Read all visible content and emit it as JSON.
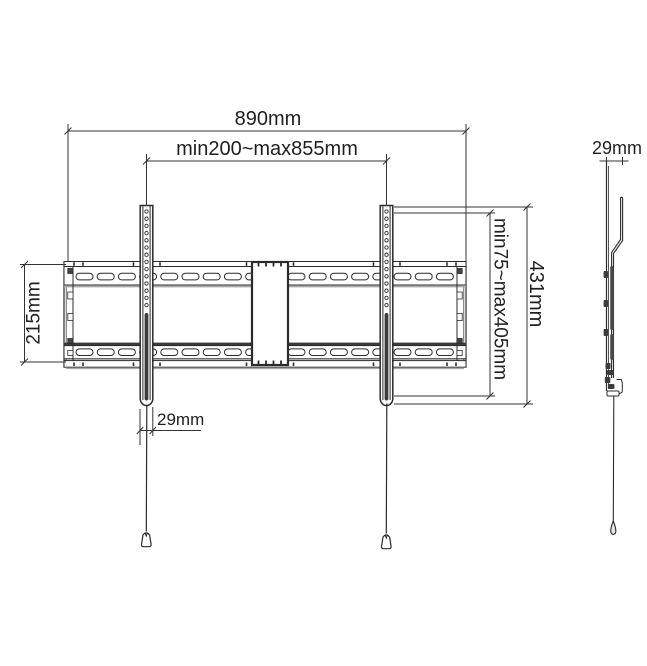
{
  "drawing": {
    "front_view": {
      "overall_width_label": "890mm",
      "vesa_width_label": "min200~max855mm",
      "plate_height_label": "215mm",
      "vesa_height_label": "min75~max405mm",
      "bracket_height_label": "431mm",
      "bracket_width_label": "29mm"
    },
    "side_view": {
      "depth_label": "29mm"
    },
    "colors": {
      "line": "#2b2b2b",
      "dim_line": "#333333",
      "dark_fill": "#3c3c3c",
      "shade": "#a8a8a8",
      "background": "#ffffff"
    }
  }
}
